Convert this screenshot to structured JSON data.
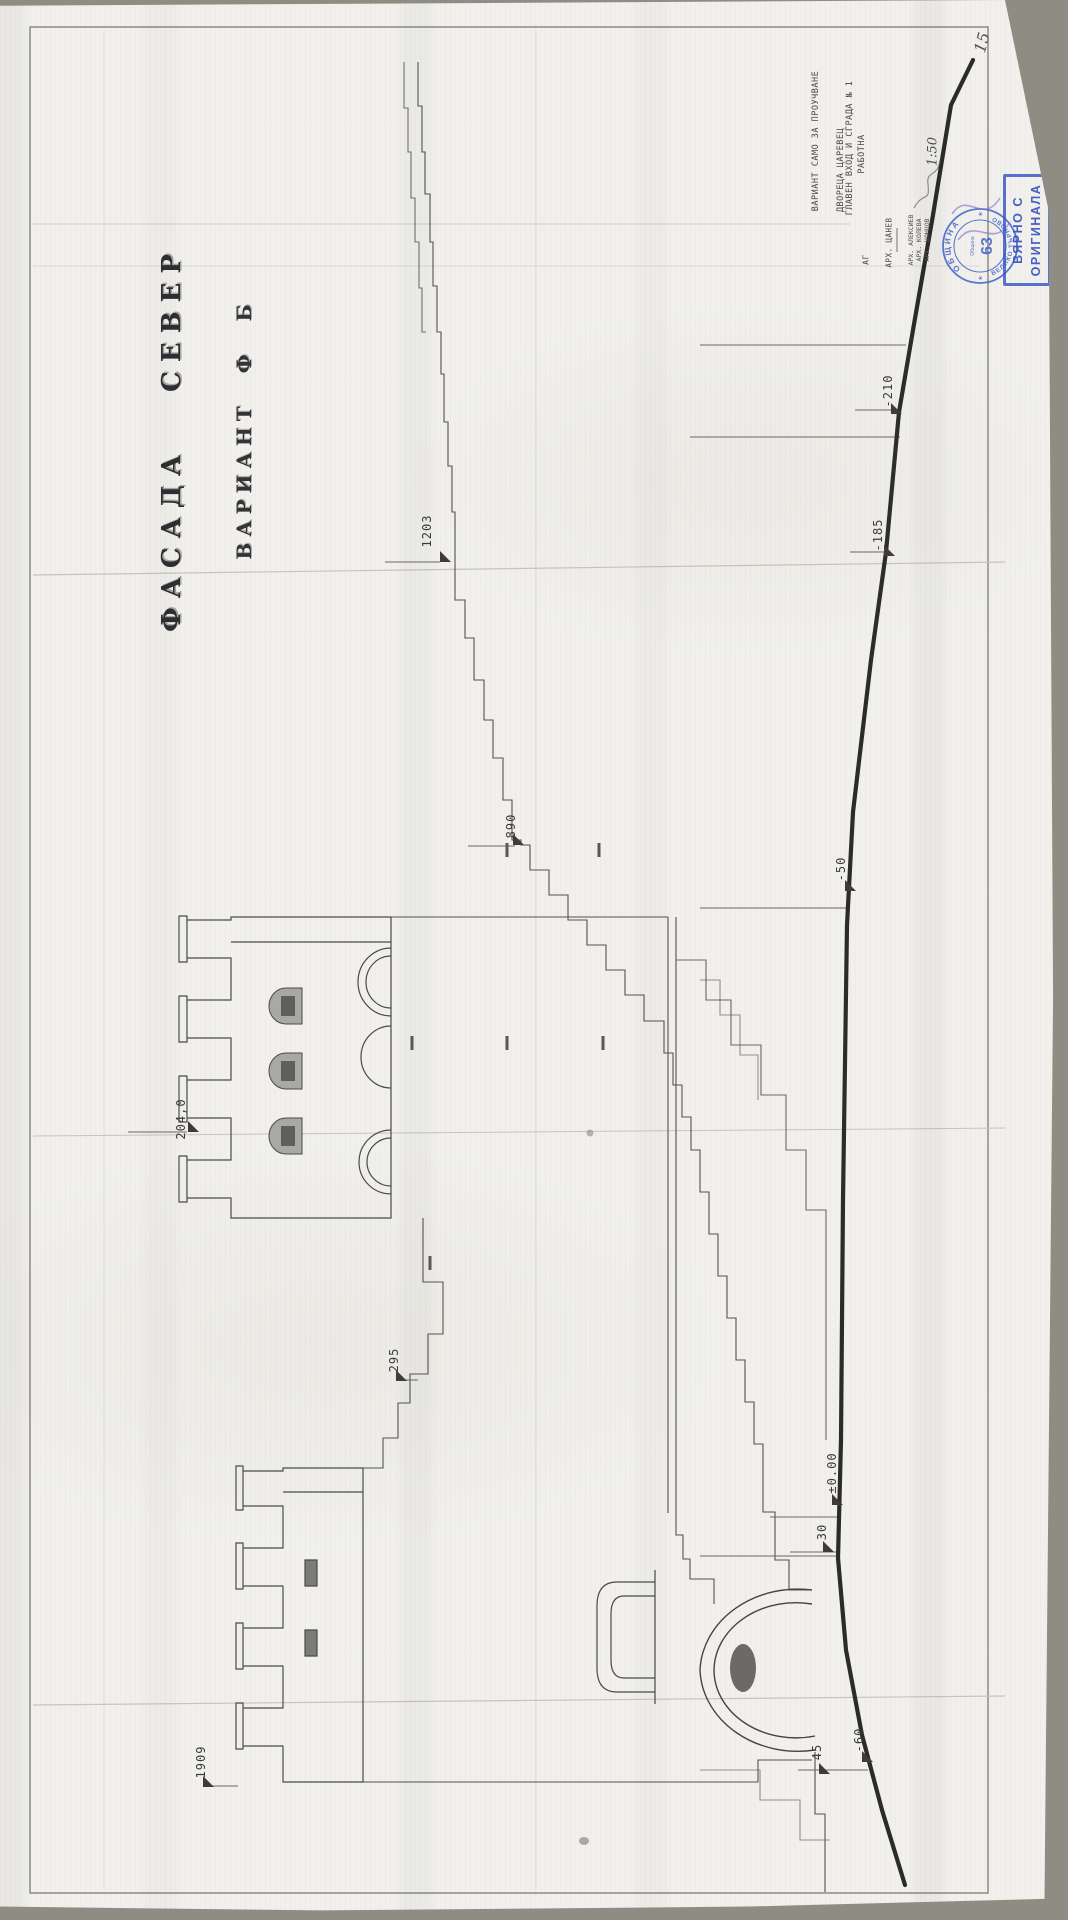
{
  "document": {
    "page_number": "15",
    "title_line1": "ФАСАДА  СЕВЕР",
    "title_line2": "ВАРИАНТ  Ф Б",
    "title_block": {
      "variant_note": "ВАРИАНТ САМО ЗА ПРОУЧВАНЕ",
      "project": "ДВОРЕЦА ЦАРЕВЕЦ",
      "drawing": "ГЛАВЕН ВХОД И СГРАДА № 1",
      "status": "РАБОТНА",
      "section_label": "АГ",
      "architect_lead": "АРХ. ЦАНЕВ",
      "team": [
        "АРХ. АЛЕКСИЕВ",
        "АРХ. КОЛЕВА",
        "АРХ. ЦОНЦОВ"
      ],
      "scale": "1:50"
    },
    "stamps": {
      "round": {
        "ring_top": "ОБЩИНА",
        "ring_bottom": "ВЕЛИКО ТЪРНОВО",
        "center_number": "63",
        "center_small": "Община",
        "star": "✶"
      },
      "rect": {
        "line1": "ВЯРНО С",
        "line2": "ОРИГИНАЛА"
      }
    },
    "elevation_marks": [
      {
        "label": "1203"
      },
      {
        "label": "890"
      },
      {
        "label": "204,0"
      },
      {
        "label": "295"
      },
      {
        "label": "1909"
      },
      {
        "label": "±0.00"
      },
      {
        "label": "30"
      },
      {
        "label": "-50"
      },
      {
        "label": "-210"
      },
      {
        "label": "-185"
      },
      {
        "label": "45"
      },
      {
        "label": "-60"
      }
    ],
    "colors": {
      "stamp_blue": "#3a57c0",
      "ink": "#4a4a4a",
      "terrain": "#2b2b2b",
      "paper": "#f1f0ec"
    }
  }
}
